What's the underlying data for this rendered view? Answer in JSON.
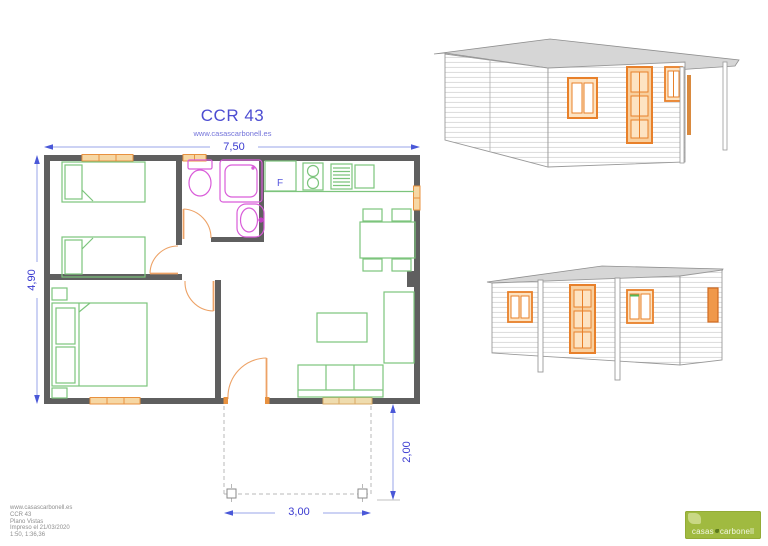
{
  "title": "CCR 43",
  "subtitle": "www.casascarbonell.es",
  "dimensions": {
    "total_width": "7,50",
    "total_depth": "4,90",
    "porch_width": "3,00",
    "porch_depth": "2,00"
  },
  "plan": {
    "fridge_label": "F"
  },
  "info_block": {
    "lines": [
      "www.casascarbonell.es",
      "CCR 43",
      "Plano Vistas",
      "Impreso el 21/03/2020",
      "1:50, 1:36,36"
    ]
  },
  "logo": {
    "text_left": "casas",
    "text_right": "carbonell"
  },
  "colors": {
    "dimension_blue": "#3a3ad0",
    "wall_gray": "#5f5f5f",
    "furniture_green": "#7cc47c",
    "fixture_magenta": "#d95cd9",
    "door_orange": "#eda266",
    "window_orange": "#e8913f",
    "roof_gray": "#d6d6d6",
    "logo_green": "#a0ba40"
  }
}
